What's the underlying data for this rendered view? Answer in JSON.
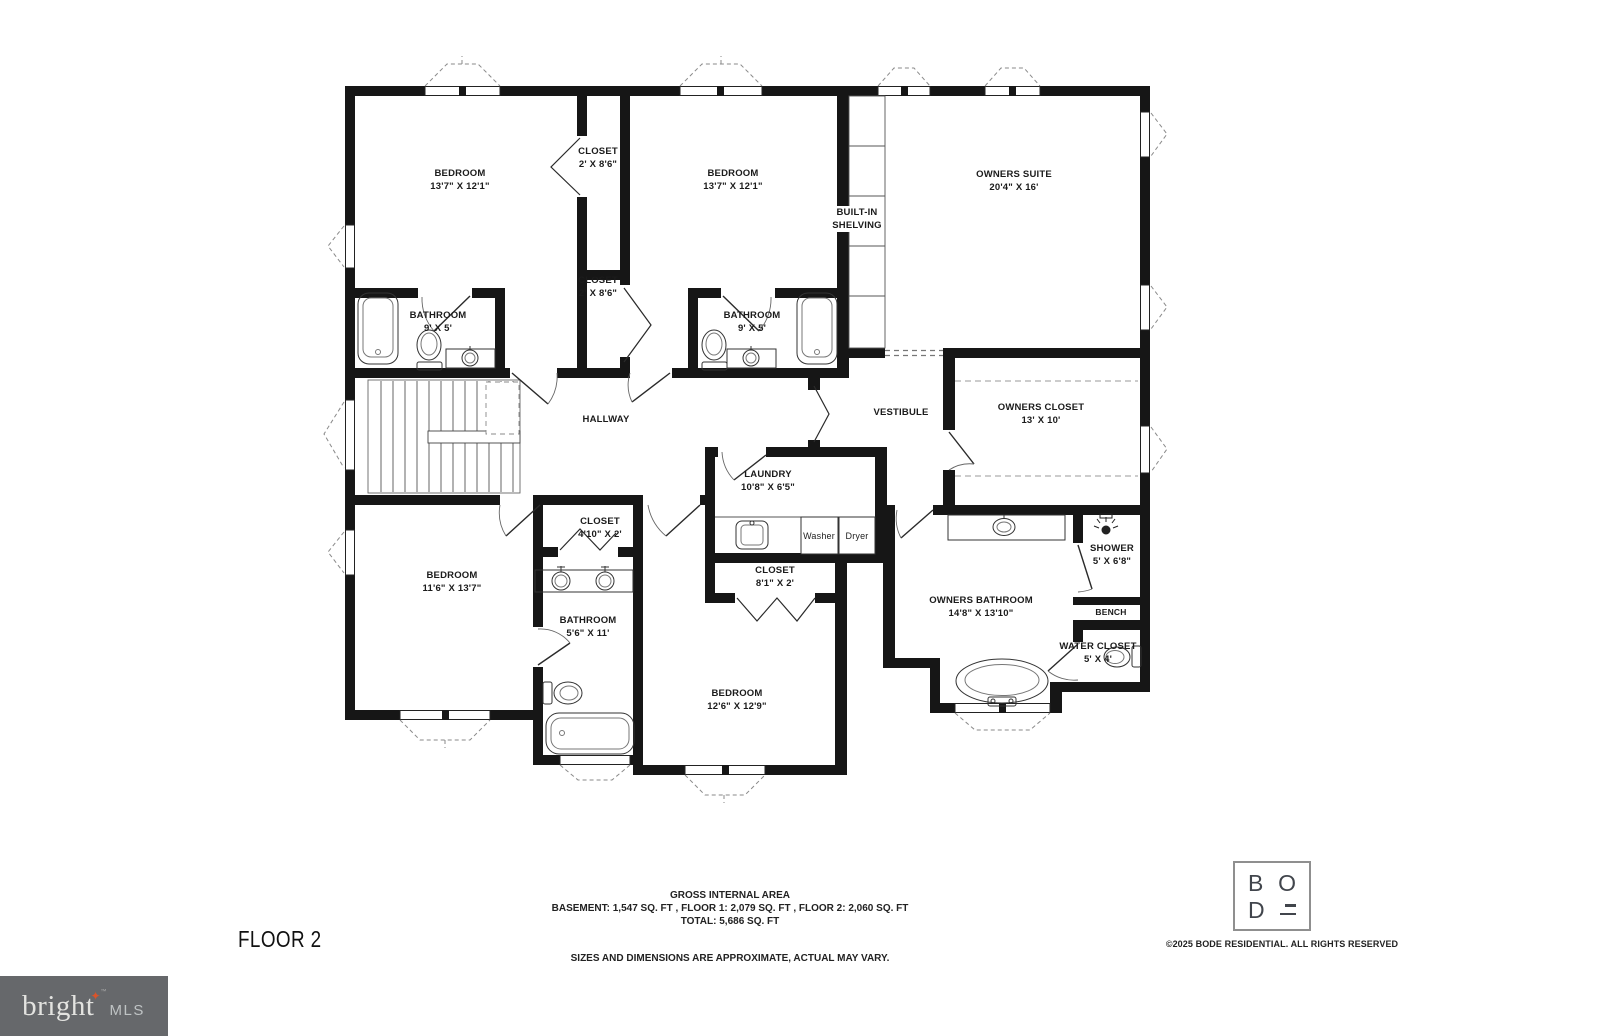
{
  "floor": {
    "label": "FLOOR 2"
  },
  "rooms": {
    "bedroom_tl": {
      "name": "BEDROOM",
      "dims": "13'7\" X 12'1\""
    },
    "closet_top": {
      "name": "CLOSET",
      "dims": "2' X 8'6\""
    },
    "closet_mid": {
      "name": "CLOSET",
      "dims": "2' X 8'6\""
    },
    "bedroom_tm": {
      "name": "BEDROOM",
      "dims": "13'7\" X 12'1\""
    },
    "owners_suite": {
      "name": "OWNERS SUITE",
      "dims": "20'4\" X 16'"
    },
    "shelving": {
      "line1": "BUILT-IN",
      "line2": "SHELVING"
    },
    "bathroom_tl": {
      "name": "BATHROOM",
      "dims": "9' X 5'"
    },
    "bathroom_tm": {
      "name": "BATHROOM",
      "dims": "9' X 5'"
    },
    "hallway": {
      "name": "HALLWAY"
    },
    "vestibule": {
      "name": "VESTIBULE"
    },
    "owners_closet": {
      "name": "OWNERS CLOSET",
      "dims": "13' X 10'"
    },
    "laundry": {
      "name": "LAUNDRY",
      "dims": "10'8\" X 6'5\""
    },
    "closet_small": {
      "name": "CLOSET",
      "dims": "4'10\" X 2'"
    },
    "bedroom_bl": {
      "name": "BEDROOM",
      "dims": "11'6\" X 13'7\""
    },
    "bathroom_bm": {
      "name": "BATHROOM",
      "dims": "5'6\" X 11'"
    },
    "closet_wide": {
      "name": "CLOSET",
      "dims": "8'1\" X 2'"
    },
    "bedroom_bm": {
      "name": "BEDROOM",
      "dims": "12'6\" X 12'9\""
    },
    "owners_bathroom": {
      "name": "OWNERS BATHROOM",
      "dims": "14'8\" X 13'10\""
    },
    "shower": {
      "name": "SHOWER",
      "dims": "5' X 6'8\""
    },
    "bench": {
      "name": "BENCH"
    },
    "water_closet": {
      "name": "WATER CLOSET",
      "dims": "5' X 4'"
    }
  },
  "appliances": {
    "washer": "Washer",
    "dryer": "Dryer"
  },
  "footer": {
    "gross_title": "GROSS INTERNAL AREA",
    "gross_line": "BASEMENT: 1,547 SQ. FT , FLOOR 1: 2,079 SQ. FT , FLOOR 2: 2,060 SQ. FT",
    "gross_total": "TOTAL: 5,686 SQ. FT",
    "disclaimer": "SIZES AND DIMENSIONS ARE APPROXIMATE, ACTUAL MAY VARY.",
    "copyright": "©2025 BODE RESIDENTIAL. ALL RIGHTS RESERVED"
  },
  "logos": {
    "bode": {
      "b": "B",
      "o": "O",
      "d": "D"
    },
    "bright": {
      "word": "bright",
      "tm": "™",
      "suffix": "MLS"
    }
  }
}
